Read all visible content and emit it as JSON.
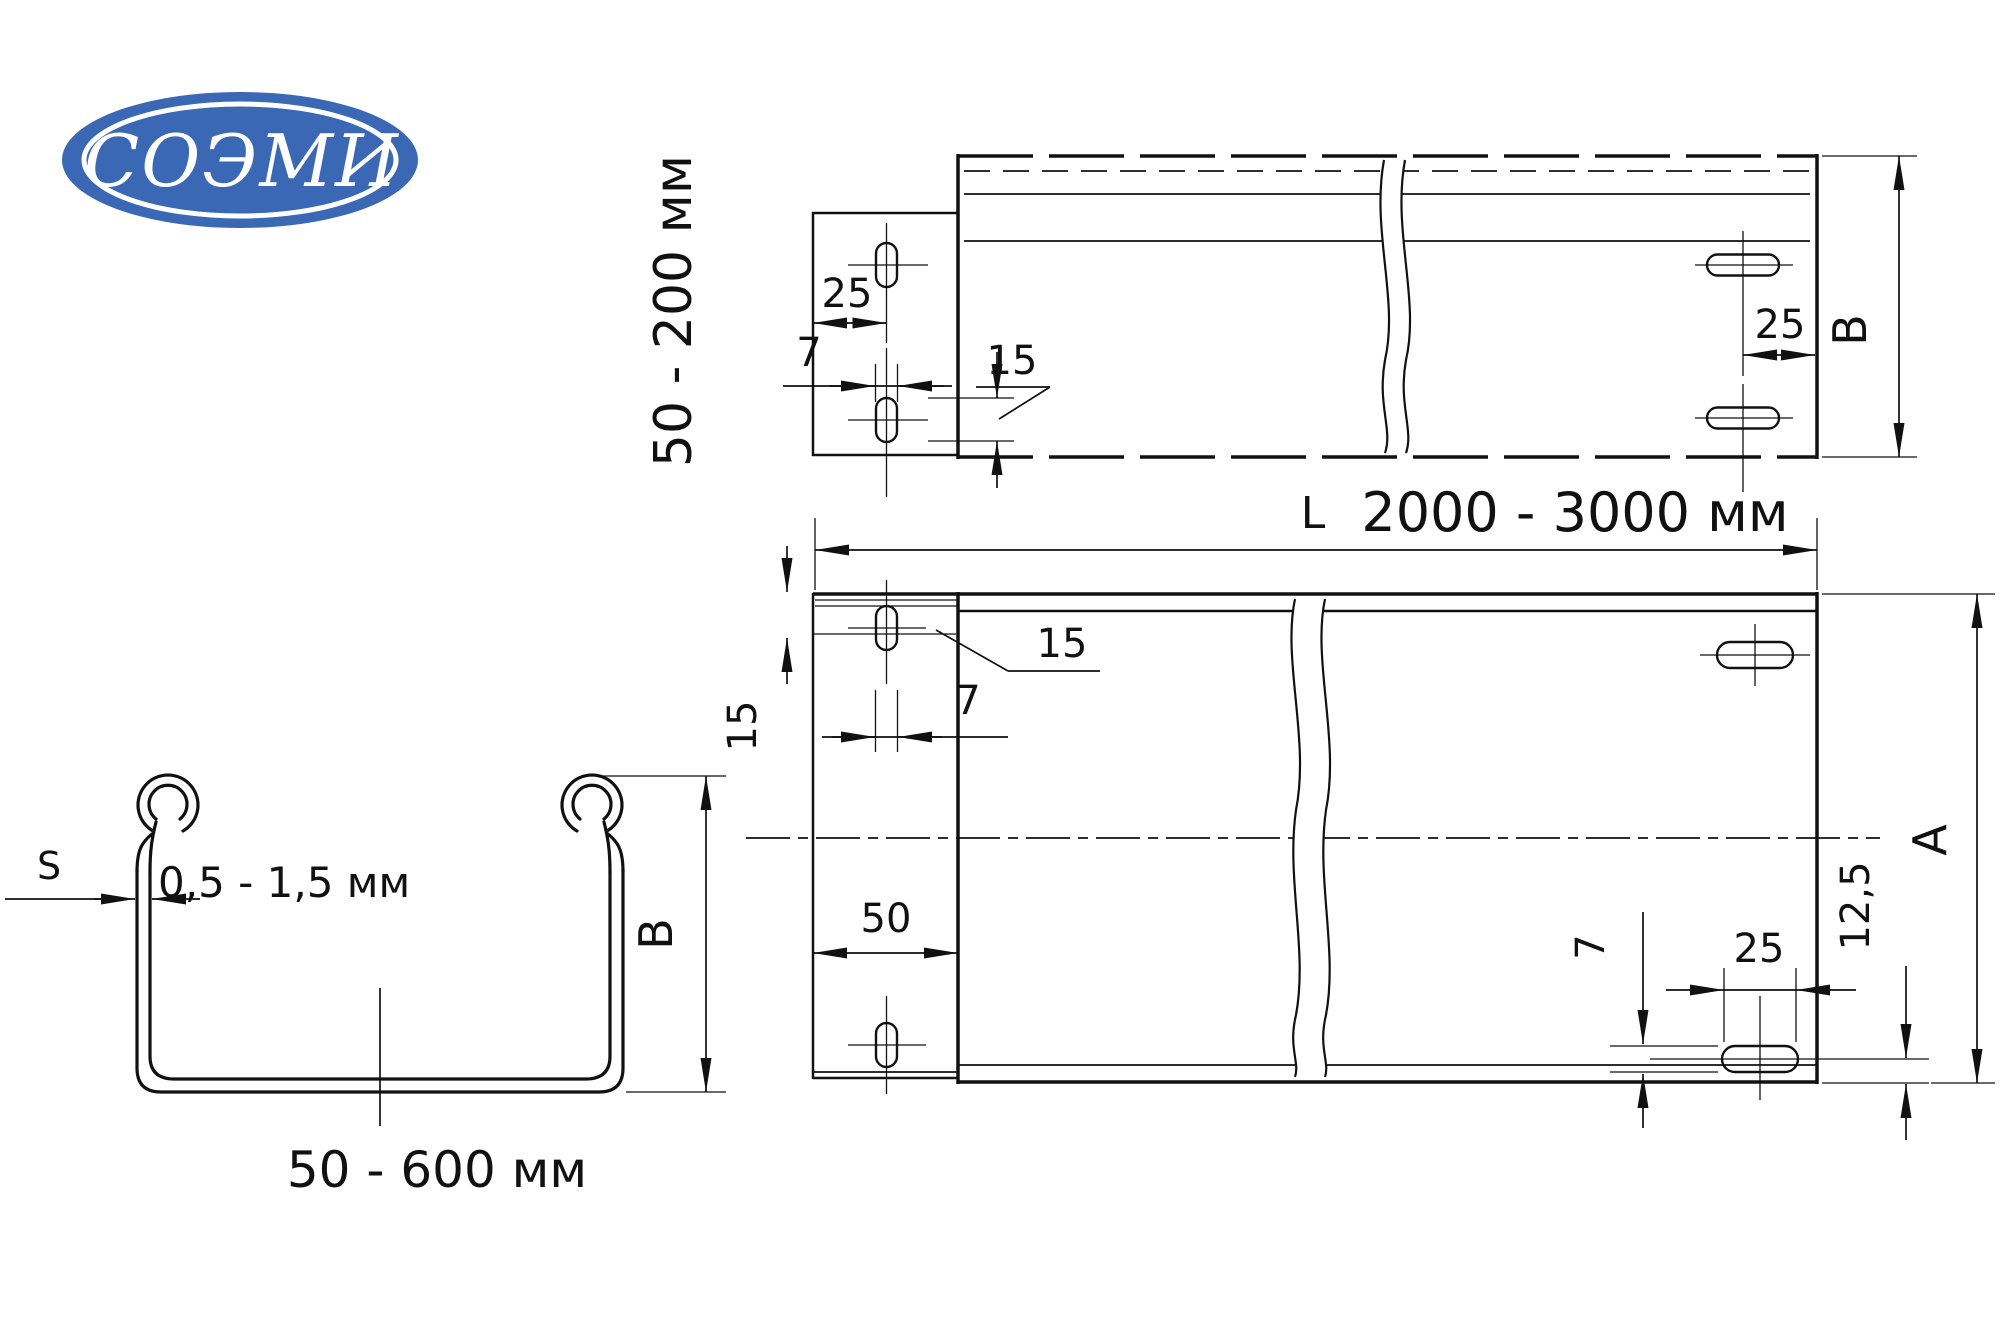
{
  "colors": {
    "background": "#ffffff",
    "line": "#111111",
    "logo_blue": "#3b68b5",
    "logo_text": "#ffffff"
  },
  "logo": {
    "text": "СОЭМИ"
  },
  "side_view": {
    "height_range_label": "50 - 200 мм",
    "tab_hole_offset": "25",
    "tab_slot_width": "7",
    "tab_slot_length": "15",
    "end_hole_offset": "25",
    "height_letter": "B"
  },
  "length_dimension": {
    "letter": "L",
    "range": "2000 - 3000 мм"
  },
  "plan_view": {
    "edge_to_slot": "15",
    "slot_length": "15",
    "slot_width": "7",
    "tab_depth": "50",
    "right_slot_width": "7",
    "right_slot_length": "25",
    "bottom_offset": "12,5",
    "width_letter": "A"
  },
  "section_view": {
    "thickness_letter": "S",
    "thickness_range": "0,5 - 1,5 мм",
    "height_letter": "B",
    "width_range": "50 - 600 мм"
  }
}
